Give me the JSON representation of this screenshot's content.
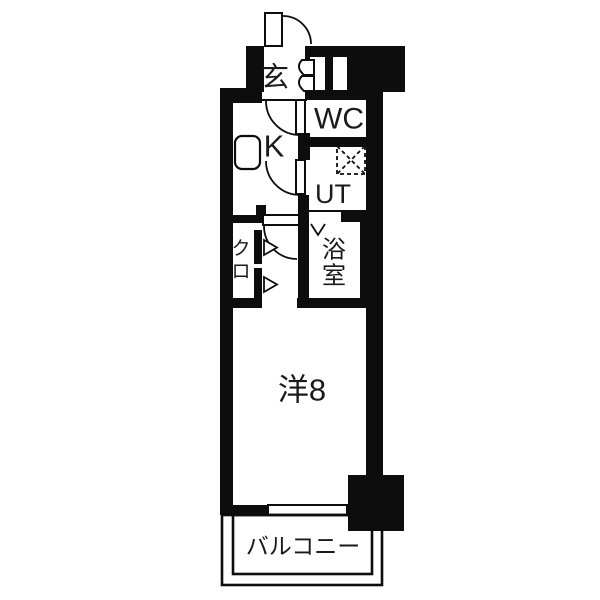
{
  "floorplan": {
    "type": "japanese-apartment-1K",
    "colors": {
      "wall": "#0d0d0d",
      "floor": "#ffffff",
      "text": "#1a1a1a"
    },
    "rooms": {
      "genkan": {
        "label": "玄"
      },
      "wc": {
        "label": "WC"
      },
      "kitchen": {
        "label": "K"
      },
      "utility": {
        "label": "UT"
      },
      "bathroom": {
        "label": "浴室",
        "chars": [
          "浴",
          "室"
        ]
      },
      "closet": {
        "label": "クロ",
        "chars": [
          "ク",
          "ロ"
        ]
      },
      "western_room": {
        "label": "洋8"
      },
      "balcony": {
        "label": "バルコニー"
      }
    },
    "icons": [
      "entrance-door-swing-icon",
      "shoe-cabinet-icon",
      "wc-door-swing-icon",
      "utility-door-swing-icon",
      "room-door-swing-icon",
      "kitchen-sink-icon",
      "washing-machine-icon",
      "bathroom-folding-door-icon",
      "closet-door-arrow-icon",
      "sliding-window-icon",
      "pillar-block",
      "meter-box-niche"
    ]
  }
}
